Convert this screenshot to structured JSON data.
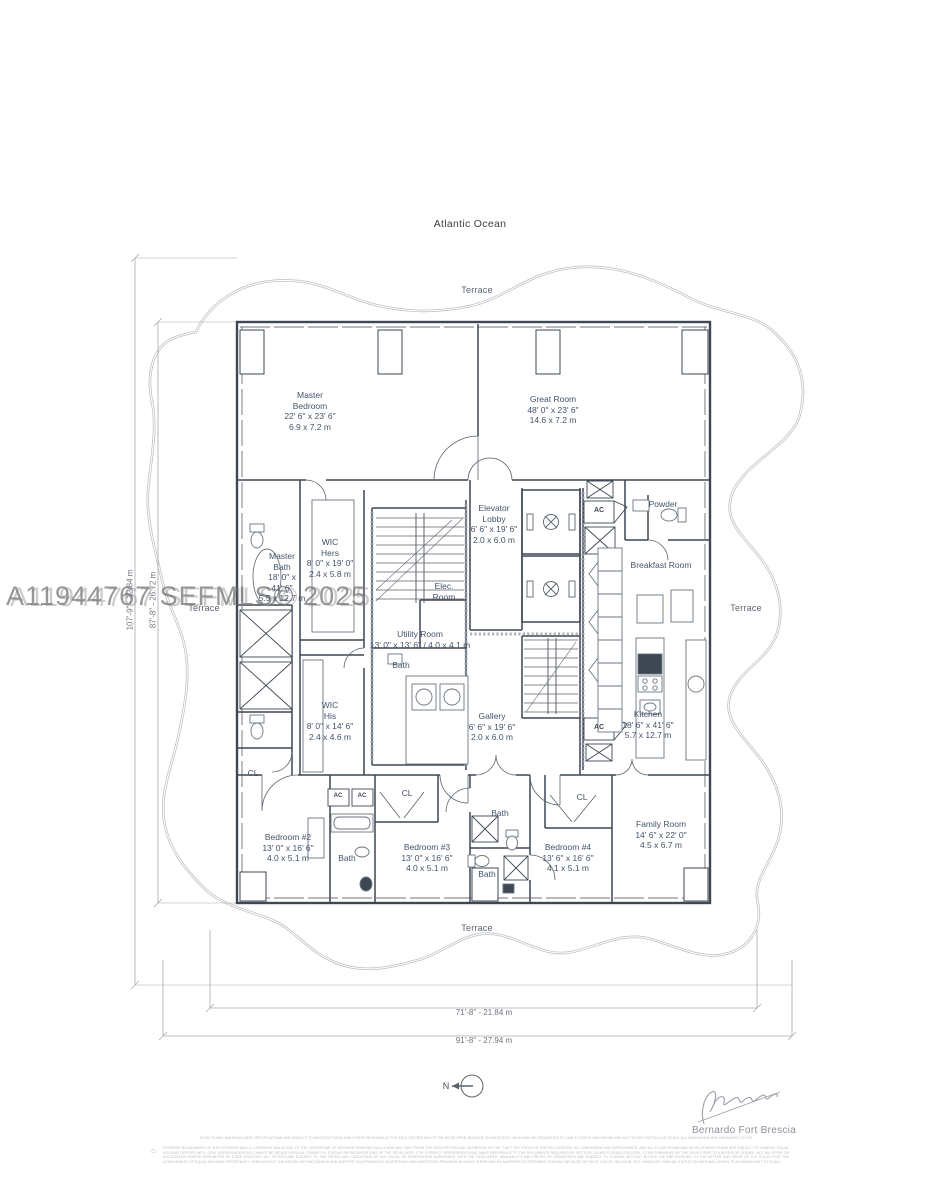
{
  "page": {
    "ocean_label": "Atlantic Ocean",
    "watermark": "A11944767  SEFMLS© 2025",
    "north_label": "N"
  },
  "terrace_labels": {
    "top": "Terrace",
    "left": "Terrace",
    "right": "Terrace",
    "bottom": "Terrace"
  },
  "dimensions": {
    "outer_height": "107'-9\" - 32.84 m",
    "inner_height": "87'-8\" - 26.72 m",
    "inner_width": "71'-8\" - 21.84 m",
    "outer_width": "91'-8\" - 27.94 m"
  },
  "rooms": {
    "master_bedroom": {
      "lines": [
        "Master",
        "Bedroom",
        "22' 6\" x 23' 6\"",
        "6.9 x 7.2 m"
      ]
    },
    "great_room": {
      "lines": [
        "Great Room",
        "48' 0\" x 23' 6\"",
        "14.6 x 7.2 m"
      ]
    },
    "elevator_lobby": {
      "lines": [
        "Elevator",
        "Lobby",
        "6' 6\" x 19' 6\"",
        "2.0 x 6.0 m"
      ]
    },
    "powder": {
      "lines": [
        "Powder"
      ]
    },
    "breakfast_room": {
      "lines": [
        "Breakfast Room"
      ]
    },
    "master_bath": {
      "lines": [
        "Master",
        "Bath",
        "18' 0\" x",
        "41' 6\"",
        "5.5 x 12.7 m"
      ]
    },
    "wic_hers": {
      "lines": [
        "WIC",
        "Hers",
        "8' 0\" x 19' 0\"",
        "2.4 x 5.8 m"
      ]
    },
    "elec_room": {
      "lines": [
        "Elec.",
        "Room"
      ]
    },
    "utility_room": {
      "lines": [
        "Utility Room",
        "13' 0\" x 13' 6\" / 4.0 x 4.1 m"
      ]
    },
    "utility_bath": {
      "lines": [
        "Bath"
      ]
    },
    "wic_his": {
      "lines": [
        "WIC",
        "His",
        "8' 0\" x 14' 6\"",
        "2.4 x 4.6 m"
      ]
    },
    "gallery": {
      "lines": [
        "Gallery",
        "6' 6\" x 19' 6\"",
        "2.0 x 6.0 m"
      ]
    },
    "kitchen": {
      "lines": [
        "Kitchen",
        "18' 6\" x 41' 6\"",
        "5.7 x 12.7 m"
      ]
    },
    "family_room": {
      "lines": [
        "Family Room",
        "14' 6\" x 22' 0\"",
        "4.5 x 6.7 m"
      ]
    },
    "bedroom_2": {
      "lines": [
        "Bedroom #2",
        "13' 0\" x 16' 6\"",
        "4.0 x 5.1 m"
      ]
    },
    "bedroom_3": {
      "lines": [
        "Bedroom #3",
        "13' 0\" x 16' 6\"",
        "4.0 x 5.1 m"
      ]
    },
    "bedroom_4": {
      "lines": [
        "Bedroom #4",
        "13' 6\" x 16' 6\"",
        "4.1 x 5.1 m"
      ]
    },
    "bath_2": {
      "lines": [
        "Bath"
      ]
    },
    "bath_3a": {
      "lines": [
        "Bath"
      ]
    },
    "bath_3b": {
      "lines": [
        "Bath"
      ]
    }
  },
  "small_labels": {
    "cl": "CL",
    "ac": "AC"
  },
  "signature": {
    "name": "Bernardo Fort Brescia"
  },
  "disclaimer": {
    "note": "NOTE: PLANS, MATERIALS AND SPECIFICATIONS ARE SUBJECT TO ARCHITECTURAL AND OTHER REVISIONS AT THE SOLE DISCRETION OF THE DEVELOPER, BUILDER OR ARCHITECT, OR AS MAY BE REQUESTED BY LAW. FLOOR PLANS SHOWN ARE NOT TO ANY PARTICULAR SCALE. ALL DIMENSIONS ARE MEASURED TO THE",
    "body": "EXTERIOR BOUNDARIES OF THE EXTERIOR WALLS, CORRIDOR WALLS AND TO THE CENTERLINE OF INTERIOR DEMISING WALLS AND MAY VARY FROM THE DESCRIPTION AND DEFINITION OF THE \"UNIT\" SET FORTH IN THE DECLARATION. ALL DIMENSIONS ARE APPROXIMATE, AND ALL FLOOR PLANS AND DEVELOPMENT PLANS ARE SUBJECT TO CHANGE. EQUAL HOUSING OPPORTUNITY. ORAL REPRESENTATIONS CANNOT BE RELIED UPON AS CORRECTLY STATING REPRESENTATIONS OF THE DEVELOPER. FOR CORRECT REPRESENTATIONS, MAKE REFERENCE TO THE DOCUMENTS REQUIRED BY SECTION 718.503 FLORIDA STATUTES, TO BE FURNISHED BY THE DEVELOPER TO A BUYER OR LESSEE. NOT AN OFFER OR SOLICITATION WHERE PROHIBITED BY STATE STATUTES. ALL OFFERS ARE SUBJECT TO THE TERMS AND CONDITIONS OF ANY SALES OR RESERVATION AGREEMENT WITH THE DEVELOPER. AVAILABILITY AND PRICES OF RESIDENCES ARE SUBJECT TO CHANGE WITHOUT NOTICE. WE ARE PLEDGED TO THE LETTER AND SPIRIT OF U.S. POLICY FOR THE ACHIEVEMENT OF EQUAL HOUSING OPPORTUNITY THROUGHOUT THE NATION. WE ENCOURAGE AND SUPPORT AN AFFIRMATIVE ADVERTISING AND MARKETING PROGRAM IN WHICH THERE ARE NO BARRIERS TO OBTAINING HOUSING BECAUSE OF RACE, COLOR, RELIGION, SEX, HANDICAP, FAMILIAL STATUS OR NATIONAL ORIGIN. PLAN DRAWN NOT TO SCALE",
    "eho_glyph": "⌂"
  },
  "colors": {
    "wall": "#3e4754",
    "label_text": "#44546a",
    "terrace_line": "#bcbfc3",
    "dimension_line": "#a7abb0",
    "watermark": "#7a7a7c"
  }
}
